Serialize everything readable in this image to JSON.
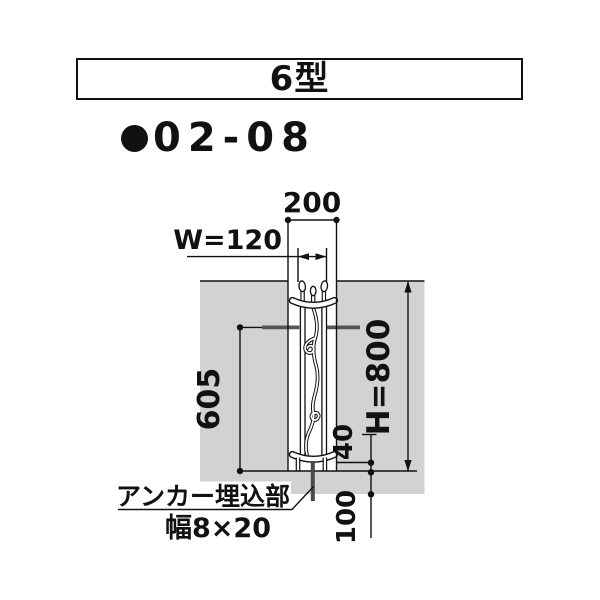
{
  "title": {
    "label": "6型"
  },
  "product_code": {
    "label": "02-08"
  },
  "diagram": {
    "dim_top_width": "200",
    "dim_post_width": "W=120",
    "dim_left_height": "605",
    "dim_total_height": "H=800",
    "dim_leg": "40",
    "dim_embed": "100",
    "anchor_label_line1": "アンカー埋込部",
    "anchor_label_line2": "幅8×20"
  },
  "icons": {
    "bullet": "filled-circle"
  },
  "colors": {
    "wall_gray": "#d2d2d2",
    "bracket_gray": "#555555",
    "anchor_gray": "#4a4a4a",
    "ink": "#111111"
  }
}
